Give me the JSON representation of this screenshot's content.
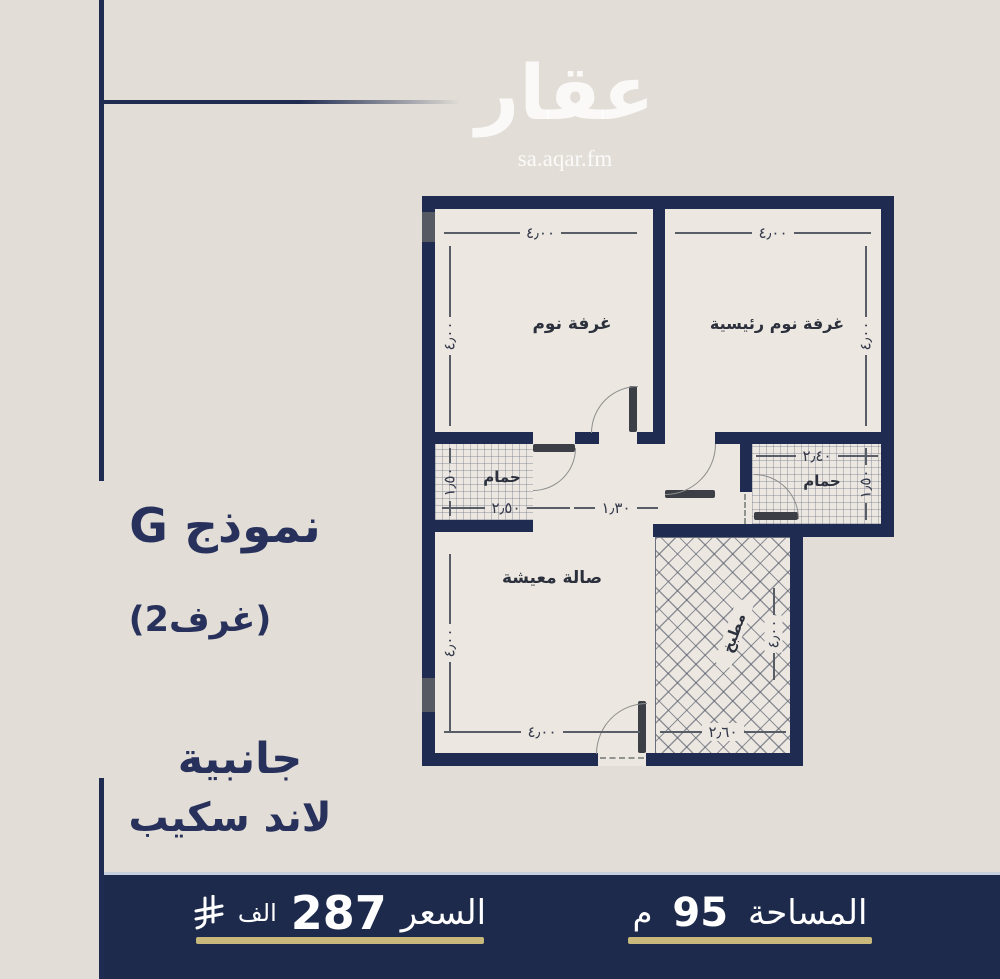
{
  "watermark": {
    "brand": "عقار",
    "site": "sa.aqar.fm"
  },
  "panel": {
    "model": "نموذج G",
    "rooms": "(2غرف)",
    "line1": "جانبية",
    "line2": "لاند سكيب"
  },
  "plan": {
    "bedroom": {
      "label": "غرفة نوم",
      "w": "٤٫٠٠",
      "h": "٤٫٠٠"
    },
    "master": {
      "label": "غرفة نوم رئيسية",
      "w": "٤٫٠٠",
      "h": "٤٫٠٠"
    },
    "bath1": {
      "label": "حمام",
      "w": "٢٫٥٠",
      "h": "١٫٥٠"
    },
    "hall": {
      "w": "١٫٣٠"
    },
    "bath2": {
      "label": "حمام",
      "w": "٢٫٤٠",
      "h": "١٫٥٠"
    },
    "living": {
      "label": "صالة معيشة",
      "w": "٤٫٠٠",
      "h": "٤٫٠٠"
    },
    "kitchen": {
      "label": "مطبخ",
      "w": "٢٫٦٠",
      "h": "٤٫٠٠"
    }
  },
  "footer": {
    "price_label": "السعر",
    "price_value": "287",
    "price_unit": "الف",
    "currency_icon": "saudi-riyal-symbol",
    "area_label": "المساحة",
    "area_value": "95",
    "area_unit": "م"
  },
  "colors": {
    "navy": "#1f2b50",
    "bar": "#1d2a4c",
    "gold": "#c9b87b",
    "background": "#e2ded7"
  }
}
